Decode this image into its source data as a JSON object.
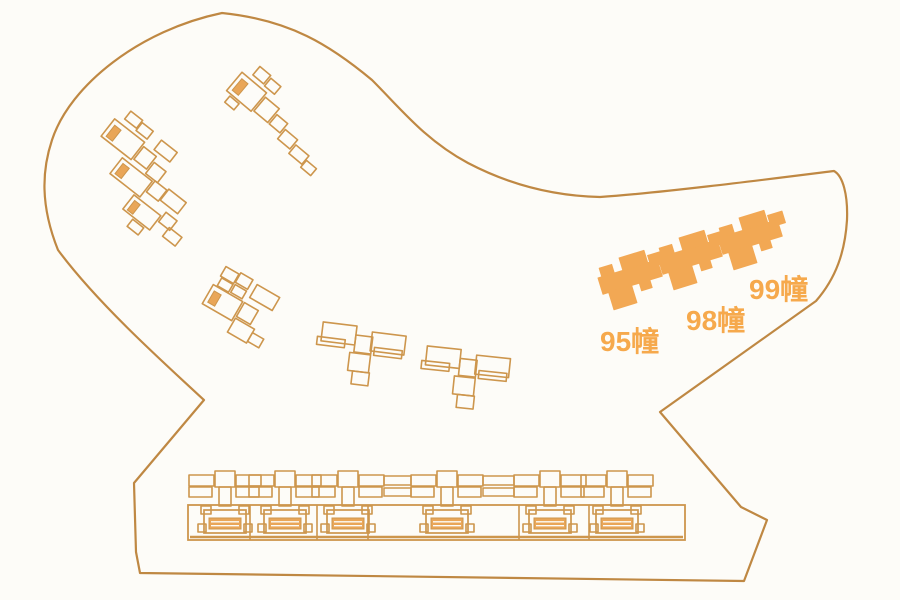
{
  "title": "residential-site-plan",
  "colors": {
    "background": "#fdfcf8",
    "boundary": "#bf8843",
    "outline": "#cd964d",
    "stripe": "#e9a658",
    "highlight": "#f2a854",
    "label": "#f6a94c",
    "hatch_line": "#fdfcf8"
  },
  "boundary": {
    "path": "M222,13 C290,20 330,45 372,80 C400,108 425,140 468,163 C510,185 555,196 600,197 C660,193 770,179 834,171 C843,176 848,195 847,220 C845,252 836,278 816,301 L660,412 L741,507 L767,520 L744,581 L140,573 L136,552 L134,483 L204,400 C155,355 95,300 58,250 C40,205 42,170 52,140 C70,85 140,30 222,13 Z",
    "stroke_width": 2.2
  },
  "highlight_shape": [
    [
      0,
      0,
      62,
      17
    ],
    [
      4,
      -9,
      13,
      9
    ],
    [
      26,
      -13,
      26,
      13
    ],
    [
      54,
      -7,
      15,
      12
    ],
    [
      6,
      17,
      24,
      18
    ],
    [
      38,
      17,
      11,
      8
    ]
  ],
  "highlighted_buildings": [
    {
      "id": "95",
      "label": "95幢",
      "origin": [
        598,
        278
      ],
      "rotation": -17,
      "label_pos": [
        600,
        351
      ],
      "font_size": 28
    },
    {
      "id": "98",
      "label": "98幢",
      "origin": [
        658,
        258
      ],
      "rotation": -17,
      "label_pos": [
        686,
        330
      ],
      "font_size": 28
    },
    {
      "id": "99",
      "label": "99幢",
      "origin": [
        718,
        238
      ],
      "rotation": -17,
      "label_pos": [
        749,
        299
      ],
      "font_size": 28
    }
  ],
  "clusters": [
    {
      "id": "a",
      "origin": [
        233,
        83
      ],
      "rotation": 40,
      "rects": [
        [
          10,
          -30,
          14,
          11
        ],
        [
          26,
          -28,
          13,
          10
        ],
        [
          0,
          -14,
          32,
          24
        ],
        [
          6,
          12,
          12,
          8
        ],
        [
          34,
          -10,
          18,
          18
        ],
        [
          54,
          -4,
          14,
          12
        ],
        [
          70,
          2,
          16,
          12
        ],
        [
          88,
          7,
          17,
          11
        ],
        [
          106,
          12,
          13,
          9
        ]
      ],
      "stripes": [
        [
          4,
          -9,
          8,
          15
        ]
      ]
    },
    {
      "id": "b",
      "origin": [
        112,
        132
      ],
      "rotation": 38,
      "rects": [
        [
          2,
          -28,
          15,
          10
        ],
        [
          18,
          -26,
          14,
          10
        ],
        [
          -6,
          -12,
          38,
          22
        ],
        [
          34,
          -8,
          16,
          16
        ],
        [
          52,
          -2,
          15,
          14
        ],
        [
          44,
          -24,
          20,
          12
        ],
        [
          24,
          14,
          38,
          20
        ],
        [
          64,
          12,
          15,
          14
        ],
        [
          80,
          10,
          22,
          14
        ],
        [
          56,
          36,
          34,
          18
        ],
        [
          92,
          30,
          14,
          12
        ],
        [
          104,
          40,
          16,
          11
        ],
        [
          70,
          56,
          14,
          9
        ]
      ],
      "stripes": [
        [
          -2,
          -7,
          8,
          14
        ],
        [
          28,
          18,
          8,
          13
        ],
        [
          60,
          40,
          7,
          12
        ]
      ]
    },
    {
      "id": "c",
      "origin": [
        224,
        270
      ],
      "rotation": 30,
      "rects": [
        [
          0,
          -4,
          15,
          11
        ],
        [
          16,
          -6,
          14,
          11
        ],
        [
          2,
          8,
          13,
          9
        ],
        [
          17,
          7,
          13,
          9
        ],
        [
          36,
          -4,
          26,
          15
        ],
        [
          -2,
          18,
          34,
          22
        ],
        [
          34,
          18,
          16,
          16
        ],
        [
          34,
          36,
          22,
          16
        ],
        [
          56,
          40,
          13,
          10
        ]
      ],
      "stripes": [
        [
          2,
          23,
          8,
          13
        ]
      ]
    },
    {
      "id": "d",
      "origin": [
        324,
        316
      ],
      "rotation": 7,
      "rects": [
        [
          0,
          6,
          34,
          19
        ],
        [
          -4,
          21,
          28,
          8
        ],
        [
          50,
          10,
          34,
          19
        ],
        [
          54,
          25,
          28,
          8
        ],
        [
          34,
          15,
          17,
          17
        ],
        [
          30,
          33,
          21,
          18
        ],
        [
          35,
          51,
          17,
          13
        ]
      ],
      "stripes": []
    },
    {
      "id": "e",
      "origin": [
        428,
        340
      ],
      "rotation": 6,
      "rects": [
        [
          0,
          6,
          34,
          19
        ],
        [
          -4,
          21,
          28,
          8
        ],
        [
          50,
          10,
          34,
          19
        ],
        [
          54,
          25,
          28,
          8
        ],
        [
          34,
          15,
          17,
          17
        ],
        [
          30,
          33,
          21,
          18
        ],
        [
          35,
          51,
          17,
          13
        ]
      ],
      "stripes": []
    }
  ],
  "bottom_row": {
    "band": {
      "x": 188,
      "y": 505,
      "w": 497,
      "h": 35
    },
    "inner_line_y": 537,
    "dividers": [
      250,
      317,
      368,
      519,
      589
    ],
    "module_centers": [
      225,
      285,
      348,
      447,
      550,
      617
    ],
    "bridges": [
      [
        348,
        447
      ],
      [
        447,
        550
      ]
    ],
    "module_shape": {
      "upper": [
        [
          -36,
          -30,
          25,
          11
        ],
        [
          -36,
          -18,
          23,
          10
        ],
        [
          -10,
          -34,
          20,
          16
        ],
        [
          -6,
          -18,
          12,
          19
        ],
        [
          11,
          -30,
          25,
          11
        ],
        [
          11,
          -18,
          23,
          10
        ]
      ],
      "house": {
        "ears": [
          [
            -24,
            1,
            10,
            8
          ],
          [
            14,
            1,
            10,
            8
          ]
        ],
        "body": [
          -21,
          5,
          42,
          23
        ],
        "feet": [
          [
            -27,
            19,
            8,
            8
          ],
          [
            19,
            19,
            8,
            8
          ]
        ],
        "hatch": [
          -16,
          13,
          32,
          11
        ]
      },
      "bridge_rows": [
        [
          -29,
          9
        ],
        [
          -17,
          8
        ]
      ]
    }
  }
}
